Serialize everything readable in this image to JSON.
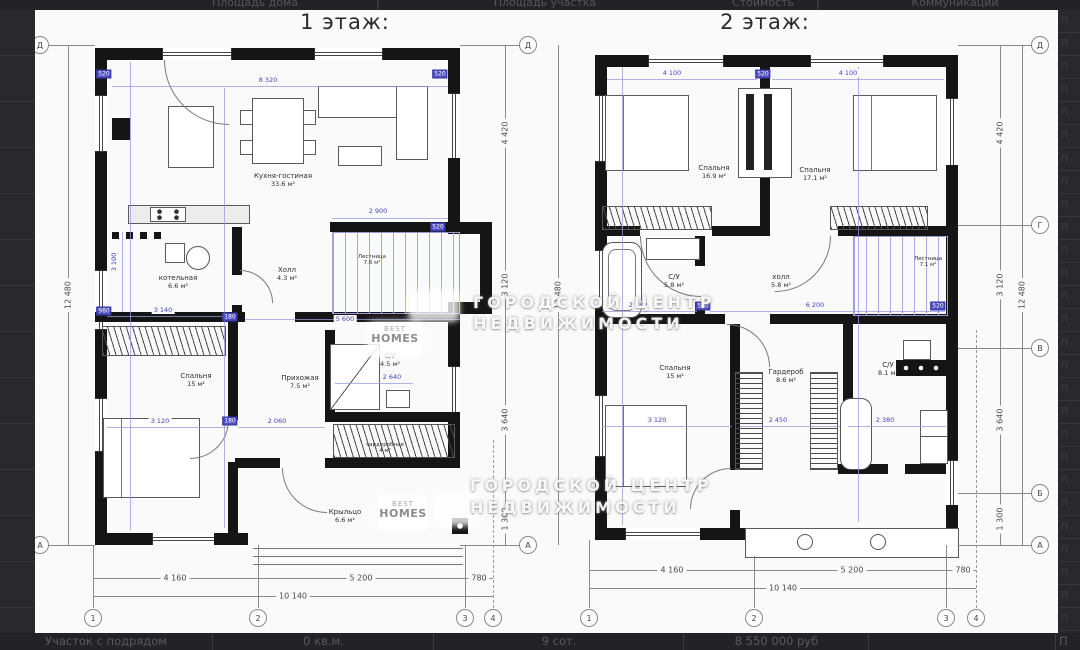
{
  "chrome": {
    "header_row": [
      "Площадь дома",
      "Площадь участка",
      "Стоимость",
      "Коммуникации"
    ],
    "header_separator": "|",
    "bottom_row": [
      "Участок с подрядом",
      "0 кв.м.",
      "9 сот.",
      "8 550 000 руб",
      "П"
    ],
    "rail_glyph": "П"
  },
  "watermark": {
    "line1": "ГОРОДСКОЙ ЦЕНТР",
    "line2": "НЕДВИЖИМОСТИ",
    "logo_line1": "BEST",
    "logo_line2": "HOMES"
  },
  "floor1": {
    "title": "1 этаж:",
    "rooms": [
      {
        "name": "Кухня-гостиная",
        "area": "33.6 м²"
      },
      {
        "name": "котельная",
        "area": "6.6 м²"
      },
      {
        "name": "Холл",
        "area": "4.3 м²"
      },
      {
        "name": "Лестница",
        "area": "7.6 м²"
      },
      {
        "name": "Спальня",
        "area": "15 м²"
      },
      {
        "name": "Прихожая",
        "area": "7.5 м²"
      },
      {
        "name": "С/У",
        "area": "4.5 м²"
      },
      {
        "name": "гардеробная",
        "area": "4 м²"
      },
      {
        "name": "Крыльцо",
        "area": "6.6 м²"
      }
    ],
    "grid": {
      "rows_left": [
        "Д",
        "А"
      ],
      "rows_right": [
        "Д",
        "А"
      ],
      "cols": [
        "1",
        "2",
        "3",
        "4"
      ]
    },
    "dims": {
      "left_total": "12 480",
      "right_segments": [
        "4 420",
        "3 120",
        "3 640",
        "1 300"
      ],
      "bottom_segments": [
        "4 160",
        "5 200",
        "780"
      ],
      "bottom_total": "10 140",
      "blue": [
        "8 320",
        "2 900",
        "3 100",
        "3 140",
        "5 600",
        "3 120",
        "2 060",
        "2 640"
      ],
      "small": [
        "520",
        "520",
        "520",
        "180",
        "180",
        "980"
      ]
    }
  },
  "floor2": {
    "title": "2 этаж:",
    "rooms": [
      {
        "name": "Спальня",
        "area": "16.9 м²"
      },
      {
        "name": "Спальня",
        "area": "17.1 м²"
      },
      {
        "name": "С/У",
        "area": "5.8 м²"
      },
      {
        "name": "холл",
        "area": "5.8 м²"
      },
      {
        "name": "Лестница",
        "area": "7.1 м²"
      },
      {
        "name": "Спальня",
        "area": "15 м²"
      },
      {
        "name": "Гардероб",
        "area": "8.6 м²"
      },
      {
        "name": "С/У",
        "area": "8.1 м²"
      }
    ],
    "grid": {
      "rows_right": [
        "Д",
        "Г",
        "В",
        "Б",
        "А"
      ],
      "cols": [
        "1",
        "2",
        "3",
        "4"
      ]
    },
    "dims": {
      "left_total": "12 480",
      "right_segments": [
        "4 420",
        "3 120",
        "3 640",
        "1 300"
      ],
      "right_total": "12 480",
      "bottom_segments": [
        "4 160",
        "5 200",
        "780"
      ],
      "bottom_total": "10 140",
      "blue": [
        "4 100",
        "520",
        "4 100",
        "2 780",
        "6 200",
        "3 120",
        "2 450",
        "2 380"
      ],
      "small": [
        "520",
        "520"
      ]
    }
  }
}
